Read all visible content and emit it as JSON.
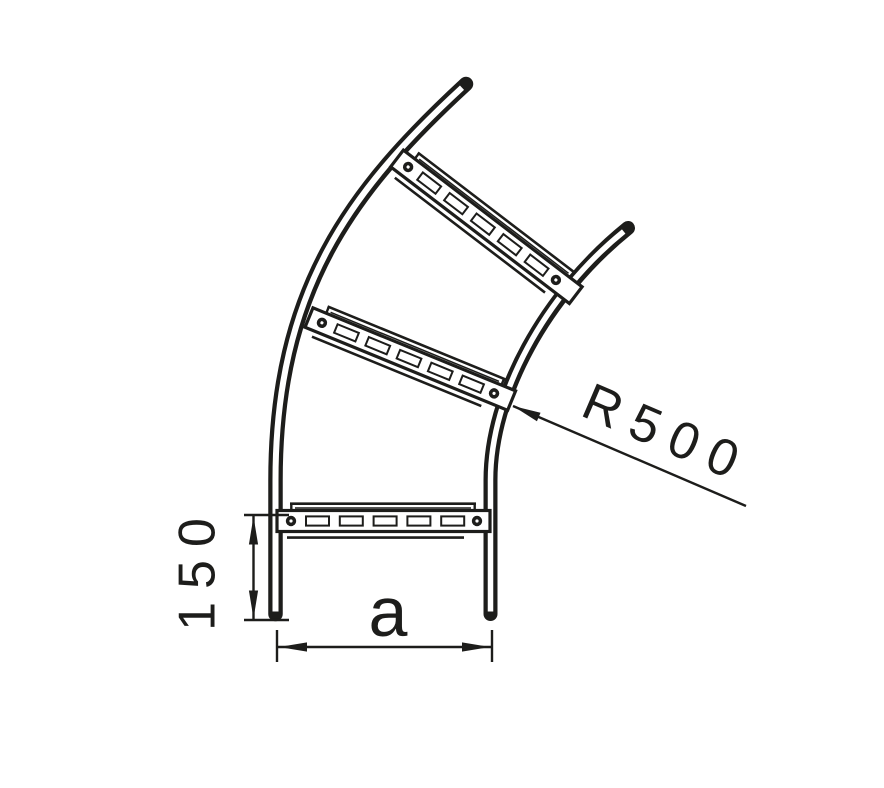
{
  "page": {
    "background": "#ffffff"
  },
  "drawing": {
    "type": "technical-line-drawing",
    "subject": "cable-ladder-bend",
    "colors": {
      "line": "#1d1d1b",
      "fill": "#ffffff"
    },
    "labels": {
      "radius": "R500",
      "straight_end_length": "150",
      "width": "a"
    },
    "dimensions": [
      {
        "label": "R500",
        "style": "leader-arrow",
        "rotation_deg": 23.2
      },
      {
        "label": "150",
        "style": "linear",
        "orientation": "vertical"
      },
      {
        "label": "a",
        "style": "linear",
        "orientation": "horizontal"
      }
    ],
    "structure": {
      "side_rails": 2,
      "rungs": 3,
      "bolt_dots_per_rung": 2,
      "slots_per_rung": 5
    }
  }
}
